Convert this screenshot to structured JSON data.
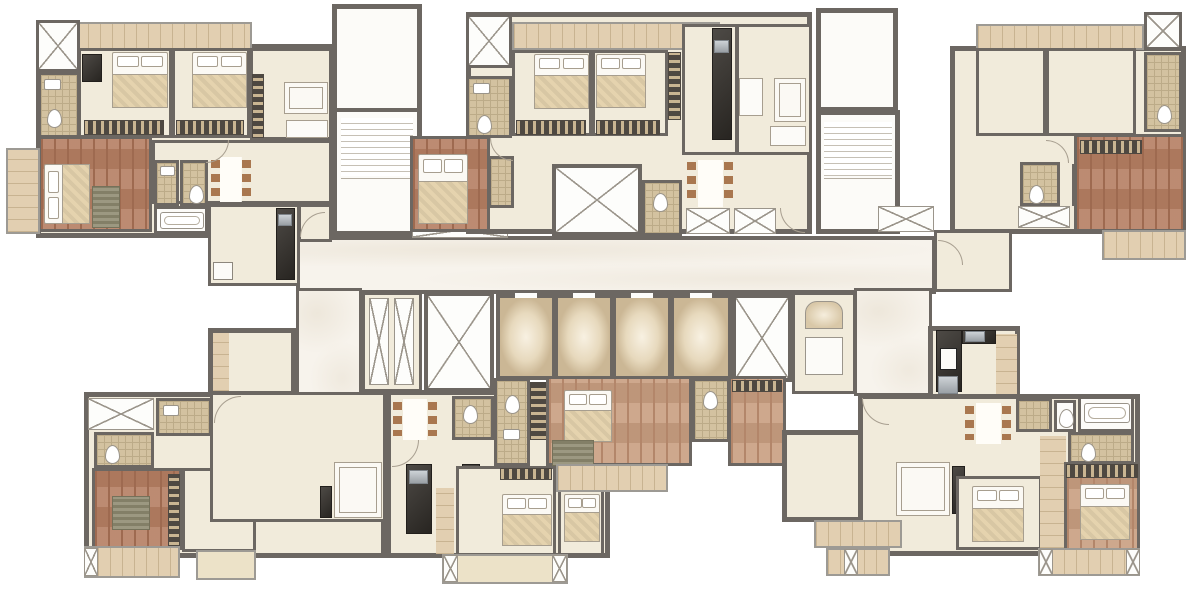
{
  "app": {
    "type": "architectural-floor-plan",
    "title": "Residential tower — typical floor plan (no visible text labels)",
    "background": "#ffffff"
  },
  "palette": {
    "wall": "#6c6762",
    "cream_floor": "#f1ebdb",
    "marble_corridor": "#f7f3ec",
    "bath_tile": "#d3c2a0",
    "bath_tile_line": "#bcab88",
    "wood_red": "#b57e62",
    "wood_red_dark": "#9e6a50",
    "wood_tan": "#c89e80",
    "wood_tan_dark": "#b3866a",
    "balcony_plank": "#e2cfb1",
    "balcony_plank_line": "#c8b391",
    "wardrobe_dark": "#4e4841",
    "wardrobe_light": "#c9b592",
    "kitchen_counter": "#35312c",
    "steel_appliance": "#9aa0a5",
    "furniture_white": "#fbf9f4",
    "furniture_border": "#a79e8f",
    "bed_blanket": "#e5d3ae",
    "chair_brown": "#a9774f",
    "rug_olive": "#8e8a70",
    "shaft_x_line": "#9b958b",
    "lift_glow_edge": "#cbb795"
  },
  "core": {
    "corridor_finish": "marble",
    "elevator_count": 4,
    "service_shaft_count": 3,
    "pressurization_duct_count": 2,
    "staircase_count": 2,
    "service_room_count": 1
  },
  "legend": {
    "cream": "living / bedrooms",
    "wood": "master bedrooms",
    "tile": "bathrooms / toilets",
    "plank": "balconies / decks / passages",
    "marble": "common corridor & lift lobby",
    "x_box": "ducts, shafts & closets",
    "comb_strip": "wardrobes",
    "dark": "kitchen counters"
  },
  "units": [
    {
      "id": "unit-top-left",
      "type": "3BHK",
      "rooms": [
        "bedroom-1",
        "bedroom-2",
        "master-bedroom",
        "bathroom-1",
        "bathroom-2",
        "bathroom-3",
        "bathtub-room",
        "dining",
        "kitchen",
        "foyer",
        "balcony",
        "deck",
        "duct"
      ]
    },
    {
      "id": "unit-top-middle",
      "type": "3BHK",
      "rooms": [
        "bedroom-1",
        "bedroom-2",
        "master-bedroom",
        "bathroom-1",
        "bathroom-2",
        "bathroom-3",
        "void-shaft",
        "dining",
        "kitchen",
        "living",
        "closets",
        "duct"
      ]
    },
    {
      "id": "unit-top-right",
      "type": "3BHK",
      "rooms": [
        "bedroom-1",
        "bedroom-2",
        "master-bedroom",
        "bathroom-1",
        "bathroom-2",
        "bathroom-3",
        "living",
        "closets",
        "balcony",
        "deck",
        "duct"
      ]
    },
    {
      "id": "unit-bottom-left",
      "type": "2BHK",
      "rooms": [
        "living",
        "master-bedroom",
        "bedroom-2",
        "bathroom-1",
        "bathroom-2",
        "closet",
        "balcony-1",
        "balcony-2",
        "entry-arm"
      ]
    },
    {
      "id": "unit-bottom-center",
      "type": "3BHK",
      "rooms": [
        "dining",
        "kitchen",
        "bathroom-1",
        "bathroom-2",
        "master-bedroom",
        "bedroom-1",
        "bedroom-2",
        "terrace-deck",
        "balcony"
      ]
    },
    {
      "id": "unit-bottom-right",
      "type": "3BHK",
      "rooms": [
        "kitchen",
        "dining",
        "living",
        "bathroom-1",
        "wc",
        "bathtub-room",
        "bedroom-1",
        "master-bedroom",
        "dress-passage",
        "balcony-1",
        "balcony-2",
        "balcony-3"
      ]
    }
  ]
}
